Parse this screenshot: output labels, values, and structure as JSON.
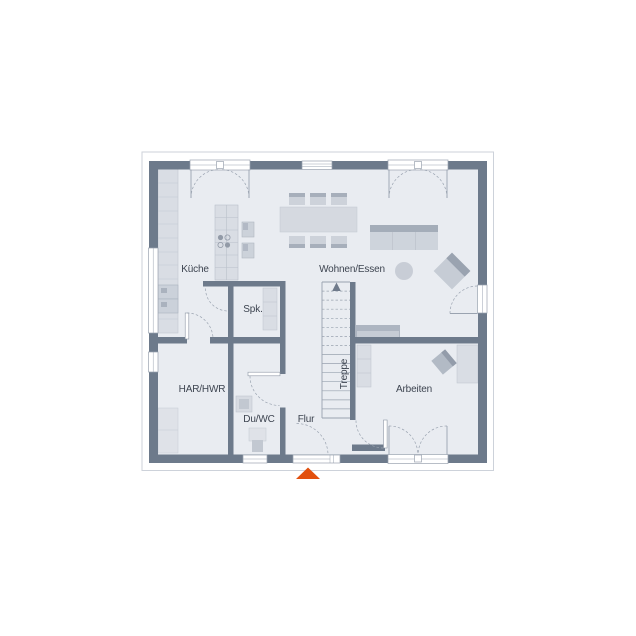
{
  "plan": {
    "type": "floor-plan",
    "rooms": [
      {
        "id": "kueche",
        "label": "Küche"
      },
      {
        "id": "wohnen-essen",
        "label": "Wohnen/Essen"
      },
      {
        "id": "spk",
        "label": "Spk."
      },
      {
        "id": "har-hwr",
        "label": "HAR/HWR"
      },
      {
        "id": "du-wc",
        "label": "Du/WC"
      },
      {
        "id": "flur",
        "label": "Flur"
      },
      {
        "id": "treppe",
        "label": "Treppe"
      },
      {
        "id": "arbeiten",
        "label": "Arbeiten"
      }
    ],
    "markers": {
      "entrance": "entrance-arrow"
    },
    "colors": {
      "wall": "#6d7a8b",
      "floor": "#e9ecf1",
      "furniture_light": "#d9dde4",
      "furniture_mid": "#cbd1da",
      "furniture_dark": "#a4adb9",
      "line": "#9aa3b0",
      "text": "#3d4450",
      "entrance_marker": "#e2500e",
      "overhang": "#cdd2da"
    },
    "furniture": [
      "kitchen-counter",
      "tall-appliance-cabinets",
      "kitchen-island",
      "cooktop",
      "kitchen-blocks",
      "dining-table",
      "dining-chairs",
      "sofa",
      "coffee-table",
      "armchair",
      "lowboard",
      "pantry-shelf",
      "laundry-appliances",
      "washbasin",
      "wc",
      "office-shelf",
      "desk",
      "office-chair",
      "staircase"
    ]
  }
}
